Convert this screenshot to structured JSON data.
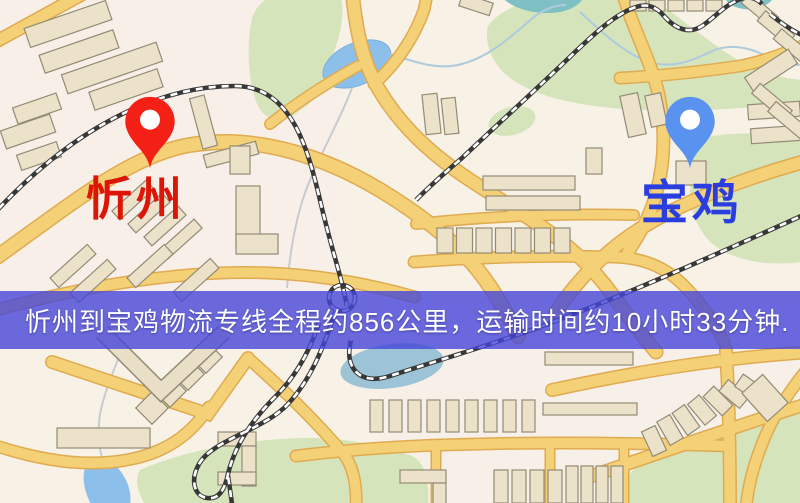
{
  "map": {
    "origin_pin": {
      "name": "忻州",
      "label_color": "#dc1507",
      "pin_color": "#f42015"
    },
    "destination_pin": {
      "name": "宝鸡",
      "label_color": "#2a3edf",
      "pin_color": "#5a92f0"
    },
    "banner": {
      "text": "忻州到宝鸡物流专线全程约856公里，运输时间约10小时33分钟.",
      "background_color": "#4646d8",
      "text_color": "#ffffff"
    },
    "route": {
      "origin": "忻州",
      "destination": "宝鸡",
      "distance_km": "856",
      "duration": "10小时33分钟"
    }
  }
}
